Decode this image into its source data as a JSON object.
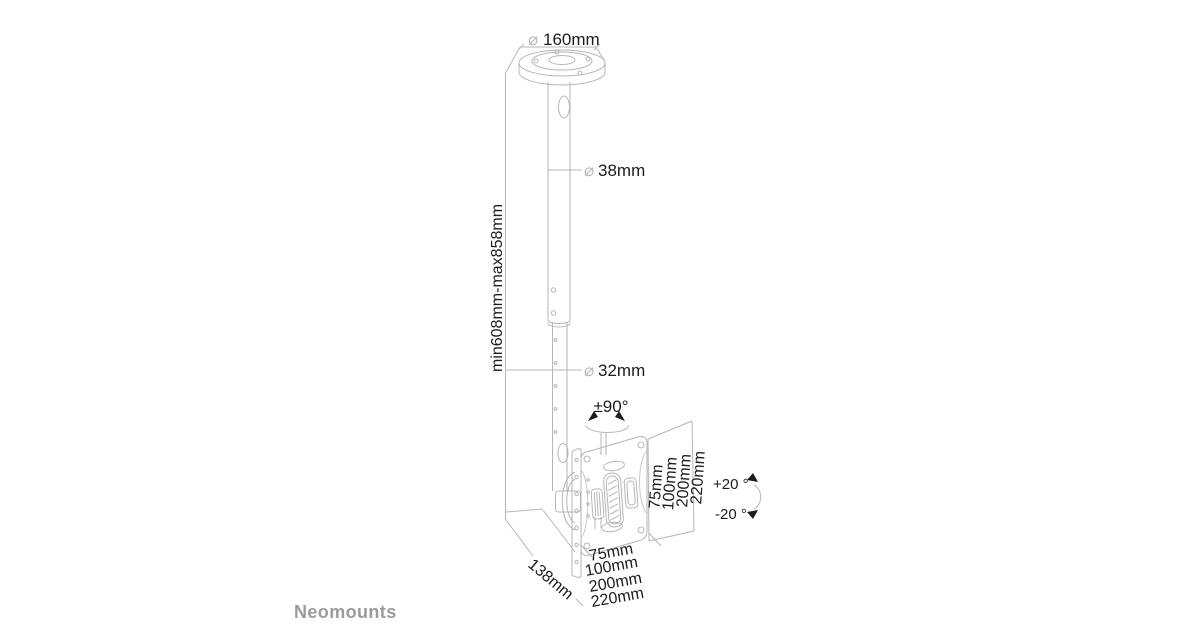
{
  "page": {
    "background": "#ffffff"
  },
  "brand": {
    "name": "Neomounts",
    "color": "#9b9b9b"
  },
  "diagram": {
    "line_color": "#b6b6b6",
    "text_color": "#1c1c1c",
    "dimensions": {
      "ceiling_plate": {
        "symbol": "⌀",
        "value": "160mm"
      },
      "upper_pole": {
        "symbol": "⌀",
        "value": "38mm"
      },
      "lower_pole": {
        "symbol": "⌀",
        "value": "32mm"
      },
      "height_range": "min608mm-max858mm",
      "swivel": "±90°",
      "tilt_up": "+20 °",
      "tilt_down": "-20 °",
      "depth": "138mm",
      "vesa_vertical": [
        "75mm",
        "100mm",
        "200mm",
        "220mm"
      ],
      "vesa_horizontal": [
        "75mm",
        "100mm",
        "200mm",
        "220mm"
      ]
    }
  }
}
